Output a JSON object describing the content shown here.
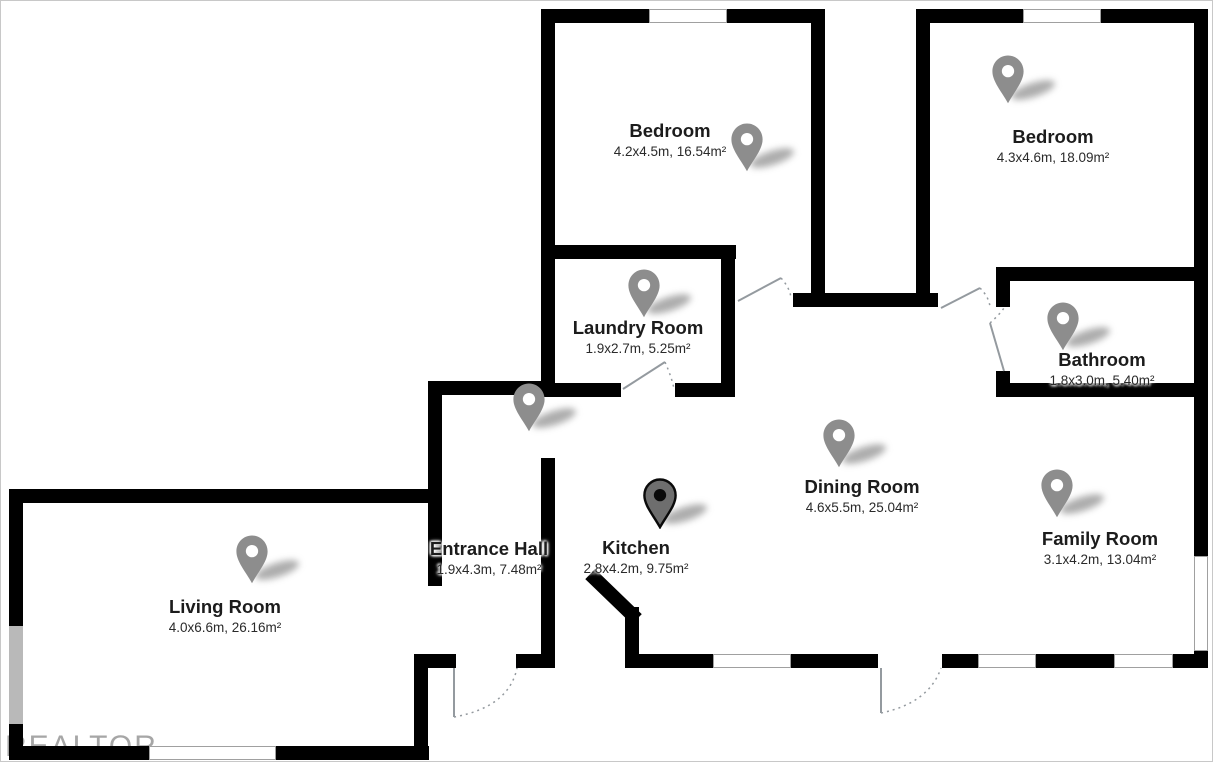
{
  "title": "Apartment floor plan",
  "watermark": "REALTOR",
  "colors": {
    "wall": "#000000",
    "window_fill": "#ffffff",
    "window_outline": "#a0a0a0",
    "window_gray": "#b9b9b9",
    "pin_gray": "#8d8d8d",
    "pin_selected_body": "#6e6e6e",
    "pin_selected_accent": "#0a0a0a",
    "door_line": "#949a9f",
    "label_text": "#1c1c1c",
    "watermark_color": "#a6a6a6"
  },
  "rooms": [
    {
      "name": "Bedroom",
      "dims": "4.2x4.5m, 16.54m²",
      "pin": "gray"
    },
    {
      "name": "Bedroom",
      "dims": "4.3x4.6m, 18.09m²",
      "pin": "gray"
    },
    {
      "name": "Laundry Room",
      "dims": "1.9x2.7m, 5.25m²",
      "pin": "gray"
    },
    {
      "name": "Bathroom",
      "dims": "1.8x3.0m, 5.40m²",
      "pin": "gray"
    },
    {
      "name": "Dining Room",
      "dims": "4.6x5.5m, 25.04m²",
      "pin": "gray"
    },
    {
      "name": "Family Room",
      "dims": "3.1x4.2m, 13.04m²",
      "pin": "gray"
    },
    {
      "name": "Entrance Hall",
      "dims": "1.9x4.3m, 7.48m²",
      "pin": "gray"
    },
    {
      "name": "Kitchen",
      "dims": "2.8x4.2m, 9.75m²",
      "pin": "dark"
    },
    {
      "name": "Living Room",
      "dims": "4.0x6.6m, 26.16m²",
      "pin": "gray"
    }
  ]
}
